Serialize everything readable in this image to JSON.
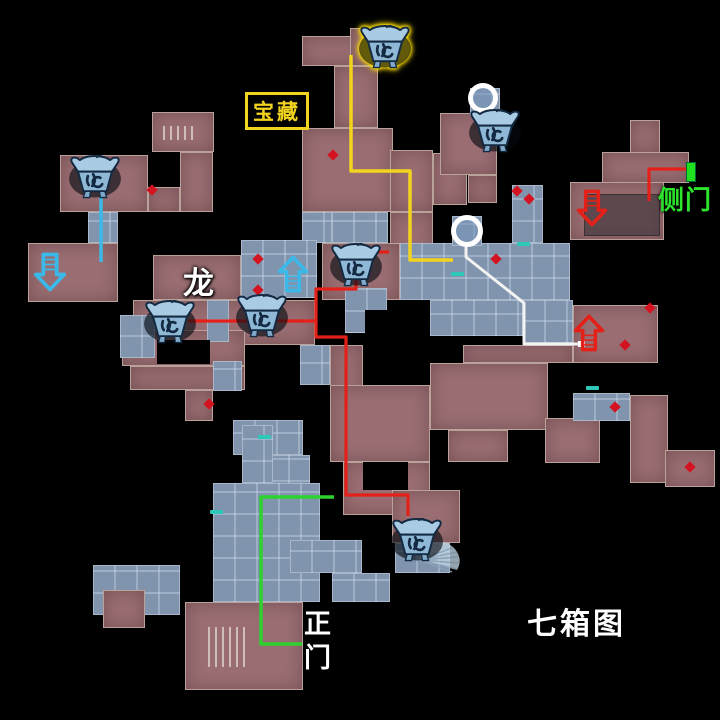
{
  "labels": {
    "treasure": "宝藏",
    "side_door": "侧门",
    "dragon": "龙",
    "main_gate_l1": "正",
    "main_gate_l2": "门",
    "map_name": "七箱图"
  },
  "colors": {
    "background": "#000000",
    "room_rose": "#996d71",
    "room_blue": "#8094ae",
    "path_yellow": "#f2d41f",
    "path_red": "#e32119",
    "path_green": "#2ed12e",
    "path_white": "#f2f2f2",
    "path_cyan": "#3ab9e9",
    "arrow_cyan": "#3ab9e9",
    "arrow_red": "#e32119",
    "door_green": "#1ee01e",
    "marker_teal": "#2ec8b8",
    "diamond_red": "#d31420",
    "treasure_text": "#f2d41f",
    "side_door_text": "#2be42b"
  },
  "rooms": [
    {
      "x": 93,
      "y": 565,
      "w": 87,
      "h": 50,
      "kind": "blue"
    },
    {
      "x": 302,
      "y": 36,
      "w": 76,
      "h": 30,
      "kind": "rose"
    },
    {
      "x": 350,
      "y": 28,
      "w": 42,
      "h": 38,
      "kind": "rose"
    },
    {
      "x": 334,
      "y": 66,
      "w": 44,
      "h": 62,
      "kind": "rose"
    },
    {
      "x": 302,
      "y": 128,
      "w": 91,
      "h": 84,
      "kind": "rose"
    },
    {
      "x": 390,
      "y": 150,
      "w": 43,
      "h": 62,
      "kind": "rose"
    },
    {
      "x": 390,
      "y": 212,
      "w": 43,
      "h": 50,
      "kind": "rose"
    },
    {
      "x": 433,
      "y": 153,
      "w": 34,
      "h": 52,
      "kind": "rose"
    },
    {
      "x": 440,
      "y": 113,
      "w": 57,
      "h": 62,
      "kind": "rose"
    },
    {
      "x": 468,
      "y": 175,
      "w": 29,
      "h": 28,
      "kind": "rose"
    },
    {
      "x": 630,
      "y": 120,
      "w": 30,
      "h": 33,
      "kind": "rose"
    },
    {
      "x": 602,
      "y": 152,
      "w": 87,
      "h": 31,
      "kind": "rose"
    },
    {
      "x": 570,
      "y": 182,
      "w": 94,
      "h": 58,
      "kind": "rose"
    },
    {
      "x": 152,
      "y": 112,
      "w": 62,
      "h": 40,
      "kind": "rose"
    },
    {
      "x": 60,
      "y": 155,
      "w": 88,
      "h": 57,
      "kind": "rose"
    },
    {
      "x": 148,
      "y": 187,
      "w": 32,
      "h": 25,
      "kind": "rose"
    },
    {
      "x": 180,
      "y": 152,
      "w": 33,
      "h": 60,
      "kind": "rose"
    },
    {
      "x": 28,
      "y": 243,
      "w": 90,
      "h": 59,
      "kind": "rose"
    },
    {
      "x": 153,
      "y": 255,
      "w": 88,
      "h": 45,
      "kind": "rose"
    },
    {
      "x": 133,
      "y": 300,
      "w": 182,
      "h": 45,
      "kind": "rose"
    },
    {
      "x": 322,
      "y": 243,
      "w": 78,
      "h": 57,
      "kind": "rose"
    },
    {
      "x": 122,
      "y": 330,
      "w": 123,
      "h": 36,
      "kind": "rose"
    },
    {
      "x": 130,
      "y": 366,
      "w": 115,
      "h": 24,
      "kind": "rose"
    },
    {
      "x": 185,
      "y": 390,
      "w": 28,
      "h": 31,
      "kind": "rose"
    },
    {
      "x": 573,
      "y": 305,
      "w": 85,
      "h": 58,
      "kind": "rose"
    },
    {
      "x": 463,
      "y": 345,
      "w": 110,
      "h": 18,
      "kind": "rose"
    },
    {
      "x": 430,
      "y": 363,
      "w": 118,
      "h": 67,
      "kind": "rose"
    },
    {
      "x": 448,
      "y": 430,
      "w": 60,
      "h": 32,
      "kind": "rose"
    },
    {
      "x": 545,
      "y": 418,
      "w": 55,
      "h": 45,
      "kind": "rose"
    },
    {
      "x": 630,
      "y": 395,
      "w": 38,
      "h": 88,
      "kind": "rose"
    },
    {
      "x": 665,
      "y": 450,
      "w": 50,
      "h": 37,
      "kind": "rose"
    },
    {
      "x": 330,
      "y": 345,
      "w": 33,
      "h": 60,
      "kind": "rose"
    },
    {
      "x": 330,
      "y": 385,
      "w": 100,
      "h": 77,
      "kind": "rose"
    },
    {
      "x": 343,
      "y": 462,
      "w": 87,
      "h": 53,
      "kind": "rose"
    },
    {
      "x": 392,
      "y": 490,
      "w": 68,
      "h": 53,
      "kind": "rose"
    },
    {
      "x": 185,
      "y": 602,
      "w": 118,
      "h": 88,
      "kind": "rose"
    },
    {
      "x": 103,
      "y": 590,
      "w": 42,
      "h": 38,
      "kind": "rose"
    },
    {
      "x": 332,
      "y": 212,
      "w": 56,
      "h": 31,
      "kind": "blue"
    },
    {
      "x": 302,
      "y": 212,
      "w": 30,
      "h": 31,
      "kind": "blue"
    },
    {
      "x": 88,
      "y": 212,
      "w": 30,
      "h": 31,
      "kind": "blue"
    },
    {
      "x": 241,
      "y": 240,
      "w": 76,
      "h": 58,
      "kind": "blue"
    },
    {
      "x": 207,
      "y": 300,
      "w": 22,
      "h": 42,
      "kind": "blue"
    },
    {
      "x": 120,
      "y": 315,
      "w": 35,
      "h": 43,
      "kind": "blue"
    },
    {
      "x": 213,
      "y": 361,
      "w": 29,
      "h": 30,
      "kind": "blue"
    },
    {
      "x": 512,
      "y": 185,
      "w": 31,
      "h": 58,
      "kind": "blue"
    },
    {
      "x": 400,
      "y": 243,
      "w": 170,
      "h": 57,
      "kind": "blue"
    },
    {
      "x": 430,
      "y": 300,
      "w": 93,
      "h": 36,
      "kind": "blue"
    },
    {
      "x": 523,
      "y": 300,
      "w": 50,
      "h": 43,
      "kind": "blue"
    },
    {
      "x": 573,
      "y": 393,
      "w": 57,
      "h": 28,
      "kind": "blue"
    },
    {
      "x": 345,
      "y": 288,
      "w": 42,
      "h": 45,
      "kind": "blue"
    },
    {
      "x": 300,
      "y": 345,
      "w": 30,
      "h": 40,
      "kind": "blue"
    },
    {
      "x": 233,
      "y": 420,
      "w": 70,
      "h": 35,
      "kind": "blue"
    },
    {
      "x": 245,
      "y": 455,
      "w": 65,
      "h": 48,
      "kind": "blue"
    },
    {
      "x": 213,
      "y": 483,
      "w": 107,
      "h": 119,
      "kind": "blue"
    },
    {
      "x": 242,
      "y": 425,
      "w": 31,
      "h": 58,
      "kind": "blue"
    },
    {
      "x": 290,
      "y": 540,
      "w": 72,
      "h": 33,
      "kind": "blue"
    },
    {
      "x": 332,
      "y": 573,
      "w": 58,
      "h": 29,
      "kind": "blue"
    },
    {
      "x": 395,
      "y": 543,
      "w": 55,
      "h": 30,
      "kind": "blue"
    },
    {
      "x": 470,
      "y": 88,
      "w": 30,
      "h": 28,
      "kind": "blue"
    },
    {
      "x": 452,
      "y": 216,
      "w": 30,
      "h": 30,
      "kind": "blue"
    },
    {
      "x": 148,
      "y": 155,
      "w": 32,
      "h": 32,
      "kind": "hole"
    },
    {
      "x": 157,
      "y": 340,
      "w": 53,
      "h": 24,
      "kind": "hole"
    },
    {
      "x": 365,
      "y": 310,
      "w": 60,
      "h": 75,
      "kind": "hole"
    },
    {
      "x": 363,
      "y": 462,
      "w": 45,
      "h": 28,
      "kind": "hole"
    },
    {
      "x": 584,
      "y": 194,
      "w": 76,
      "h": 42,
      "kind": "shade"
    },
    {
      "x": 163,
      "y": 126,
      "w": 35,
      "h": 14,
      "kind": "grate"
    },
    {
      "x": 208,
      "y": 627,
      "w": 42,
      "h": 40,
      "kind": "grate"
    }
  ],
  "paths": [
    {
      "name": "treasure-route",
      "color": "#f2d41f",
      "width": 3.5,
      "points": [
        [
          351,
          55
        ],
        [
          351,
          171
        ],
        [
          410,
          171
        ],
        [
          410,
          260
        ],
        [
          453,
          260
        ]
      ]
    },
    {
      "name": "red-route-main",
      "color": "#e32119",
      "width": 3.2,
      "points": [
        [
          188,
          321
        ],
        [
          316,
          321
        ],
        [
          316,
          289
        ],
        [
          356,
          289
        ],
        [
          356,
          268
        ]
      ]
    },
    {
      "name": "red-route-branch",
      "color": "#e32119",
      "width": 3.2,
      "points": [
        [
          316,
          321
        ],
        [
          316,
          337
        ],
        [
          346,
          337
        ],
        [
          346,
          495
        ],
        [
          408,
          495
        ],
        [
          408,
          516
        ]
      ]
    },
    {
      "name": "red-route-stub",
      "color": "#e32119",
      "width": 3.2,
      "points": [
        [
          366,
          252
        ],
        [
          389,
          252
        ]
      ]
    },
    {
      "name": "side-door-route",
      "color": "#e32119",
      "width": 3.2,
      "points": [
        [
          687,
          169
        ],
        [
          649,
          169
        ],
        [
          649,
          201
        ]
      ]
    },
    {
      "name": "main-gate-route",
      "color": "#2ed12e",
      "width": 3.5,
      "points": [
        [
          334,
          497
        ],
        [
          261,
          497
        ],
        [
          261,
          644
        ],
        [
          302,
          644
        ]
      ]
    },
    {
      "name": "white-route",
      "color": "#f2f2f2",
      "width": 3,
      "points": [
        [
          466,
          243
        ],
        [
          466,
          257
        ],
        [
          524,
          303
        ],
        [
          524,
          344
        ],
        [
          581,
          344
        ]
      ]
    },
    {
      "name": "chest-drop-line",
      "color": "#3ab9e9",
      "width": 3.5,
      "points": [
        [
          101,
          190
        ],
        [
          101,
          262
        ]
      ]
    }
  ],
  "chests": [
    {
      "x": 385,
      "y": 47,
      "highlight": true
    },
    {
      "x": 495,
      "y": 131,
      "highlight": false
    },
    {
      "x": 95,
      "y": 177,
      "highlight": false
    },
    {
      "x": 356,
      "y": 265,
      "highlight": false
    },
    {
      "x": 170,
      "y": 322,
      "highlight": false
    },
    {
      "x": 262,
      "y": 316,
      "highlight": false
    },
    {
      "x": 417,
      "y": 540,
      "highlight": false
    }
  ],
  "circles": [
    {
      "cx": 483,
      "cy": 98,
      "r": 15
    },
    {
      "cx": 467,
      "cy": 231,
      "r": 16
    }
  ],
  "arrows": [
    {
      "dir": "down",
      "color": "#3ab9e9",
      "x": 33,
      "y": 252,
      "w": 34,
      "h": 40
    },
    {
      "dir": "up",
      "color": "#3ab9e9",
      "x": 276,
      "y": 255,
      "w": 34,
      "h": 38
    },
    {
      "dir": "down",
      "color": "#e32119",
      "x": 576,
      "y": 189,
      "w": 32,
      "h": 38
    },
    {
      "dir": "up",
      "color": "#e32119",
      "x": 572,
      "y": 314,
      "w": 34,
      "h": 38
    }
  ],
  "diamonds": [
    [
      333,
      155
    ],
    [
      517,
      191
    ],
    [
      529,
      199
    ],
    [
      496,
      259
    ],
    [
      152,
      190
    ],
    [
      209,
      404
    ],
    [
      625,
      345
    ],
    [
      615,
      407
    ],
    [
      690,
      467
    ],
    [
      258,
      259
    ],
    [
      258,
      290
    ],
    [
      650,
      308
    ]
  ],
  "door_dashes": [
    [
      523,
      244
    ],
    [
      457,
      274
    ],
    [
      264,
      437
    ],
    [
      216,
      512
    ],
    [
      592,
      388
    ]
  ],
  "door_marker": {
    "x": 686,
    "y": 162,
    "w": 8,
    "h": 18
  },
  "white_dot": {
    "x": 578,
    "y": 341
  },
  "fan": {
    "x": 416,
    "y": 542,
    "w": 44,
    "h": 36
  }
}
